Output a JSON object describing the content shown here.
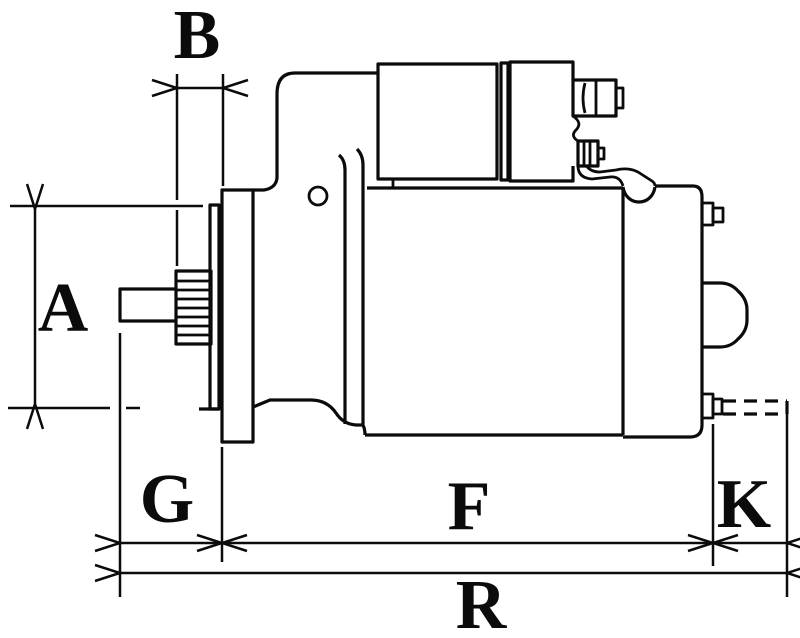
{
  "drawing": {
    "dimension_labels": {
      "b": "B",
      "a": "A",
      "g": "G",
      "f": "F",
      "k": "K",
      "r": "R"
    }
  },
  "colors": {
    "line": "#0b0b0b",
    "background": "#ffffff"
  }
}
